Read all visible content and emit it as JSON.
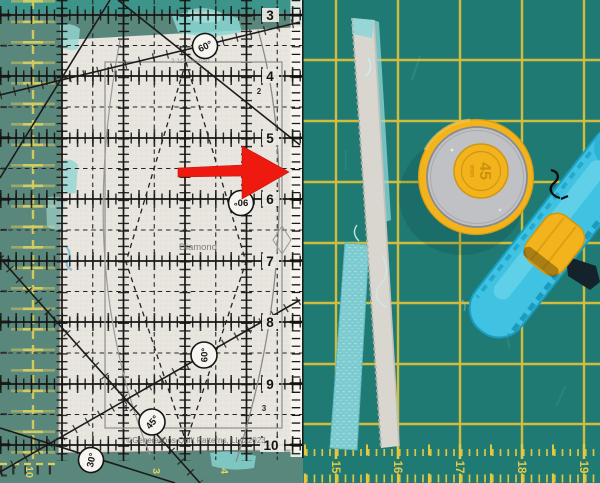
{
  "meta": {
    "description": "Photo of a quilting setup: Diamond template acrylic ruler over cream fabric on a green cutting mat, red arrow annotation, cut fabric strips, and a 45 mm rotary cutter on a teal mat",
    "width": 600,
    "height": 483
  },
  "ruler": {
    "edge_numbers": [
      "3",
      "4",
      "5",
      "6",
      "7",
      "8",
      "9",
      "10"
    ],
    "interior_labels": [
      "2",
      "1",
      "3"
    ],
    "angle_badges": [
      {
        "label": "60°"
      },
      {
        "label": "90°"
      },
      {
        "label": "60°"
      },
      {
        "label": "45°"
      },
      {
        "label": "30°"
      }
    ],
    "template_name": "Diamond",
    "size_note": "3 1/2 finished",
    "copyright": "©Generations Quilt Patterns, LLC 2023"
  },
  "annotation": {
    "arrow_color": "#ee1a10"
  },
  "cutter": {
    "blade_size": "45",
    "blade_unit": "mm",
    "body_color": "#40c3e3",
    "accent_color": "#f2b31c",
    "blade_color": "#c0c1c5"
  },
  "mat_right": {
    "bottom_numbers": [
      "15",
      "16",
      "17",
      "18",
      "19"
    ],
    "base_color": "#1f7a74",
    "grid_color": "#dfc23a"
  },
  "mat_left": {
    "bottom_numbers": [
      "10",
      "3",
      "4"
    ],
    "base_color": "#4e7e72"
  },
  "fabric": {
    "color": "#e7e3dd"
  },
  "strips": {
    "teal_color": "#7ccbd1",
    "white_color": "#d9d6d0"
  }
}
